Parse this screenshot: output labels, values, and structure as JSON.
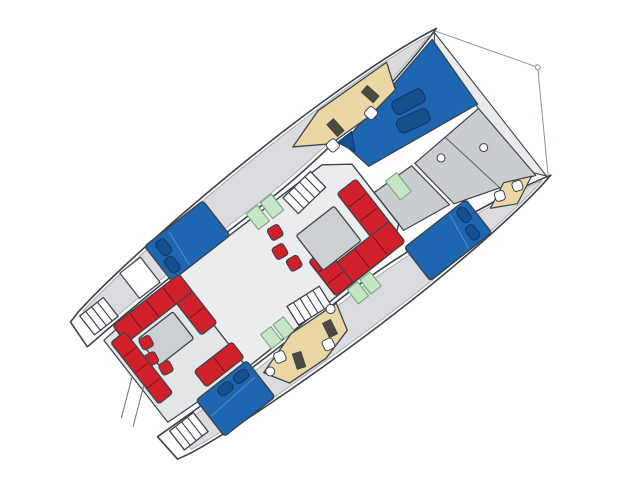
{
  "canvas": {
    "width": 640,
    "height": 478,
    "background": "#ffffff"
  },
  "boat": {
    "rotation_deg": 52,
    "origin_x": 492,
    "origin_y": 103,
    "description": "catamaran-deck-floorplan"
  },
  "palette": {
    "outline": "#3c424a",
    "soft_outline": "#8a9096",
    "hull_white": "#fdfdfd",
    "deck_gray": "#d9dbde",
    "panel_gray": "#c9ccd0",
    "saloon_gray": "#ebecee",
    "cockpit_gray": "#e4e5e7",
    "table_gray": "#cdd0d3",
    "berth_blue": "#1d67b2",
    "pillow_blue": "#164f8d",
    "seat_red": "#d2202a",
    "galley_tan": "#ead7a4",
    "equip_dark": "#4b4b43",
    "head_green": "#c5e5c6",
    "green_stroke": "#6fa173",
    "white": "#ffffff"
  },
  "legend": [
    {
      "color_key": "berth_blue",
      "meaning": "beds / sunpads / trampoline"
    },
    {
      "color_key": "seat_red",
      "meaning": "sofas and seating"
    },
    {
      "color_key": "galley_tan",
      "meaning": "galley / nav furniture"
    },
    {
      "color_key": "head_green",
      "meaning": "bathroom pads"
    },
    {
      "color_key": "panel_gray",
      "meaning": "deck panels / tables"
    }
  ],
  "shapes": [
    {
      "name": "bridle-line-port",
      "type": "line",
      "x1": -91,
      "y1": 0,
      "x2": 0,
      "y2": -58,
      "stroke": "#8a9096",
      "sw": 1
    },
    {
      "name": "bridle-line-starboard",
      "type": "line",
      "x1": 91,
      "y1": 0,
      "x2": 0,
      "y2": -58,
      "stroke": "#8a9096",
      "sw": 1
    },
    {
      "name": "bridle-ring",
      "type": "circle",
      "cx": 0,
      "cy": -58,
      "r": 2.5,
      "fill": "#ffffff",
      "stroke": "#8a9096",
      "sw": 1
    },
    {
      "name": "port-hull",
      "type": "path",
      "d": "M -93 -2 C -102 42 -107 130 -106 215 C -105 305 -99 402 -90 455 L -87 467 L -57 469 C -61 395 -62 315 -61 245 C -60 165 -77 55 -93 -2 Z",
      "fill": "#fdfdfd",
      "sw": 1.6
    },
    {
      "name": "starboard-hull",
      "type": "path",
      "d": "M 93 -2 C 102 42 107 130 106 215 C 105 305 99 402 90 455 L 87 467 L 57 469 C 61 395 62 315 61 245 C 60 165 77 55 93 -2 Z",
      "fill": "#fdfdfd",
      "sw": 1.6
    },
    {
      "name": "port-hull-deck",
      "type": "path",
      "d": "M -92 8 C -100 48 -104 132 -103 214 C -102 300 -96 398 -88 450 L -62 452 C -65 390 -66 312 -65 244 C -64 168 -79 60 -92 8 Z",
      "fill": "#d9dbde",
      "stroke": "#9aa0a6",
      "sw": 0.8
    },
    {
      "name": "starboard-hull-deck",
      "type": "path",
      "d": "M 92 8 C 100 48 104 132 103 214 C 102 300 96 398 88 450 L 62 452 C 65 390 66 312 65 244 C 64 168 79 60 92 8 Z",
      "fill": "#d9dbde",
      "stroke": "#9aa0a6",
      "sw": 0.8
    },
    {
      "name": "front-crossbeam",
      "type": "polygon",
      "points": "-91,2 91,2 76,14 -76,14",
      "fill": "#e9eaec",
      "sw": 1.1
    },
    {
      "name": "trampoline",
      "type": "polygon",
      "points": "-87,8 -8,12 -26,136 -60,142",
      "fill": "#1d67b2",
      "sw": 1.3
    },
    {
      "name": "trampoline-cushion-1",
      "type": "rect",
      "x": -60,
      "y": 48,
      "w": 15,
      "h": 34,
      "rx": 5,
      "rot": 10,
      "fill": "#164f8d",
      "stroke": "#0d3768",
      "sw": 1
    },
    {
      "name": "trampoline-cushion-2",
      "type": "rect",
      "x": -42,
      "y": 56,
      "w": 15,
      "h": 34,
      "rx": 5,
      "rot": 14,
      "fill": "#164f8d",
      "stroke": "#0d3768",
      "sw": 1
    },
    {
      "name": "trampoline-corner-cushion",
      "type": "polygon",
      "points": "-64,128 -46,138 -64,146",
      "fill": "#164f8d",
      "stroke": "#0d3768",
      "sw": 1
    },
    {
      "name": "foredeck-panel-1",
      "type": "polygon",
      "points": "-4,14 84,10 56,92 0,98",
      "fill": "#c9ccd0",
      "sw": 1.2
    },
    {
      "name": "foredeck-panel-2",
      "type": "polygon",
      "points": "0,102 54,96 46,148 -2,148",
      "fill": "#c9ccd0",
      "sw": 1.2
    },
    {
      "name": "foredeck-divider",
      "type": "line",
      "x1": -2,
      "y1": 58,
      "x2": 72,
      "y2": 46,
      "stroke": "#565b61",
      "sw": 1
    },
    {
      "name": "deck-hatch-1",
      "type": "circle",
      "cx": 30,
      "cy": 34,
      "r": 4,
      "fill": "#ffffff",
      "sw": 1
    },
    {
      "name": "deck-hatch-2",
      "type": "circle",
      "cx": 12,
      "cy": 74,
      "r": 4,
      "fill": "#ffffff",
      "sw": 1
    },
    {
      "name": "foredoor-green-pad",
      "type": "rect",
      "x": -4,
      "y": 118,
      "w": 24,
      "h": 14,
      "fill": "#c5e5c6",
      "stroke": "#6fa173",
      "sw": 1
    },
    {
      "name": "saloon-body",
      "type": "polygon",
      "points": "-56,172 -38,148 38,148 56,172 58,356 -58,356",
      "fill": "#ebecee",
      "sw": 1.4
    },
    {
      "name": "cockpit-floor",
      "type": "polygon",
      "points": "-58,356 58,356 52,452 -52,452",
      "fill": "#e4e5e7",
      "sw": 1.2
    },
    {
      "name": "port-nav-desk",
      "type": "path",
      "d": "M -97 58 L -70 68 L -65 104 L -67 152 L -88 184 L -101 142 Z",
      "fill": "#ead7a4",
      "sw": 1.3
    },
    {
      "name": "port-nav-equipment-1",
      "type": "rect",
      "x": -90,
      "y": 86,
      "w": 16,
      "h": 9,
      "rot": -10,
      "fill": "#4b4b43",
      "sw": 0.8
    },
    {
      "name": "port-nav-equipment-2",
      "type": "rect",
      "x": -85,
      "y": 134,
      "w": 16,
      "h": 9,
      "rot": -4,
      "fill": "#4b4b43",
      "sw": 0.8
    },
    {
      "name": "port-nav-chair-1",
      "type": "rect",
      "x": -72,
      "y": 96,
      "w": 11,
      "h": 11,
      "rx": 3,
      "rot": -10,
      "fill": "#ffffff",
      "sw": 1
    },
    {
      "name": "port-nav-chair-2",
      "type": "rect",
      "x": -70,
      "y": 146,
      "w": 11,
      "h": 11,
      "rx": 3,
      "rot": -4,
      "fill": "#ffffff",
      "sw": 1
    },
    {
      "name": "port-companionway-stairs",
      "type": "stairs",
      "x": -56,
      "y": 184,
      "w": 22,
      "h": 38,
      "steps": 5,
      "rot": -6
    },
    {
      "name": "port-head-green-pad-1",
      "type": "rect",
      "x": -64,
      "y": 230,
      "w": 20,
      "h": 14,
      "fill": "#c5e5c6",
      "stroke": "#6fa173",
      "sw": 1
    },
    {
      "name": "port-head-green-pad-2",
      "type": "rect",
      "x": -64,
      "y": 248,
      "w": 20,
      "h": 14,
      "fill": "#c5e5c6",
      "stroke": "#6fa173",
      "sw": 1
    },
    {
      "name": "port-aft-cabin-bed",
      "type": "rect",
      "x": -101,
      "y": 288,
      "w": 44,
      "h": 74,
      "rx": 3,
      "fill": "#1d67b2",
      "sw": 1.4
    },
    {
      "name": "port-bed-crease",
      "type": "line",
      "x1": -97,
      "y1": 334,
      "x2": -59,
      "y2": 338,
      "stroke": "#4e86c6",
      "sw": 1.2
    },
    {
      "name": "port-bed-pillow-1",
      "type": "rect",
      "x": -97,
      "y": 342,
      "w": 17,
      "h": 11,
      "rx": 4,
      "fill": "#164f8d",
      "stroke": "#0d3768",
      "sw": 1
    },
    {
      "name": "port-bed-pillow-2",
      "type": "rect",
      "x": -78,
      "y": 346,
      "w": 17,
      "h": 11,
      "rx": 4,
      "fill": "#164f8d",
      "stroke": "#0d3768",
      "sw": 1
    },
    {
      "name": "port-aft-berth-white",
      "type": "rect",
      "x": -95,
      "y": 372,
      "w": 32,
      "h": 26,
      "fill": "#ffffff",
      "sw": 1.2
    },
    {
      "name": "port-transom-steps",
      "type": "stairs",
      "x": -86,
      "y": 426,
      "w": 24,
      "h": 30,
      "steps": 4,
      "rot": 0
    },
    {
      "name": "saloon-sofa-front-bench",
      "type": "rect",
      "x": -24,
      "y": 154,
      "w": 72,
      "h": 24,
      "rx": 3,
      "seg": 4,
      "fill": "#d2202a",
      "sw": 1.3
    },
    {
      "name": "saloon-sofa-right-bench",
      "type": "rect",
      "x": 30,
      "y": 154,
      "w": 26,
      "h": 88,
      "rx": 3,
      "seg": 4,
      "fill": "#d2202a",
      "sw": 1.3
    },
    {
      "name": "saloon-sofa-return-bench",
      "type": "rect",
      "x": 12,
      "y": 220,
      "w": 44,
      "h": 22,
      "rx": 3,
      "seg": 3,
      "fill": "#d2202a",
      "sw": 1.3
    },
    {
      "name": "saloon-table",
      "type": "rect",
      "x": -16,
      "y": 188,
      "w": 44,
      "h": 48,
      "rx": 2,
      "fill": "#cdd0d3",
      "sw": 1.3
    },
    {
      "name": "saloon-stool-1",
      "type": "rect",
      "x": -38,
      "y": 244,
      "w": 13,
      "h": 13,
      "rx": 3,
      "rot": 8,
      "fill": "#d2202a",
      "sw": 1.1
    },
    {
      "name": "saloon-stool-2",
      "type": "rect",
      "x": -20,
      "y": 252,
      "w": 13,
      "h": 13,
      "rx": 3,
      "rot": 8,
      "fill": "#d2202a",
      "sw": 1.1
    },
    {
      "name": "saloon-stool-3",
      "type": "rect",
      "x": -2,
      "y": 248,
      "w": 13,
      "h": 13,
      "rx": 3,
      "rot": 8,
      "fill": "#d2202a",
      "sw": 1.1
    },
    {
      "name": "starboard-companionway-stairs",
      "type": "stairs",
      "x": 36,
      "y": 250,
      "w": 22,
      "h": 38,
      "steps": 5,
      "rot": 6
    },
    {
      "name": "starboard-saloon-green-1",
      "type": "rect",
      "x": 40,
      "y": 296,
      "w": 18,
      "h": 13,
      "fill": "#c5e5c6",
      "stroke": "#6fa173",
      "sw": 1
    },
    {
      "name": "starboard-saloon-green-2",
      "type": "rect",
      "x": 40,
      "y": 312,
      "w": 18,
      "h": 13,
      "fill": "#c5e5c6",
      "stroke": "#6fa173",
      "sw": 1
    },
    {
      "name": "starboard-bow-seats",
      "type": "polygon",
      "points": "82,14 95,42 82,66 70,40",
      "fill": "#ead7a4",
      "sw": 1.2
    },
    {
      "name": "starboard-bow-chair-1",
      "type": "rect",
      "x": 76,
      "y": 26,
      "w": 10,
      "h": 10,
      "rx": 3,
      "rot": 20,
      "fill": "#ffffff",
      "sw": 1
    },
    {
      "name": "starboard-bow-chair-2",
      "type": "rect",
      "x": 73,
      "y": 46,
      "w": 10,
      "h": 10,
      "rx": 3,
      "rot": 20,
      "fill": "#ffffff",
      "sw": 1
    },
    {
      "name": "starboard-fwd-cabin-bed",
      "type": "rect",
      "x": 60,
      "y": 80,
      "w": 42,
      "h": 78,
      "rx": 3,
      "fill": "#1d67b2",
      "sw": 1.4
    },
    {
      "name": "starboard-fwd-pillow-1",
      "type": "rect",
      "x": 63,
      "y": 86,
      "w": 16,
      "h": 10,
      "rx": 4,
      "fill": "#164f8d",
      "stroke": "#0d3768",
      "sw": 1
    },
    {
      "name": "starboard-fwd-pillow-2",
      "type": "rect",
      "x": 82,
      "y": 90,
      "w": 16,
      "h": 10,
      "rx": 4,
      "fill": "#164f8d",
      "stroke": "#0d3768",
      "sw": 1
    },
    {
      "name": "starboard-fwd-bed-crease",
      "type": "line",
      "x1": 62,
      "y1": 102,
      "x2": 100,
      "y2": 108,
      "stroke": "#4e86c6",
      "sw": 1.2
    },
    {
      "name": "starboard-head-green-1",
      "type": "rect",
      "x": 58,
      "y": 200,
      "w": 18,
      "h": 13,
      "fill": "#c5e5c6",
      "stroke": "#6fa173",
      "sw": 1
    },
    {
      "name": "starboard-head-green-2",
      "type": "rect",
      "x": 58,
      "y": 216,
      "w": 18,
      "h": 13,
      "fill": "#c5e5c6",
      "stroke": "#6fa173",
      "sw": 1
    },
    {
      "name": "starboard-galley-counter",
      "type": "path",
      "d": "M 62 246 L 90 254 L 99 288 L 96 332 L 72 346 L 58 300 Z",
      "fill": "#ead7a4",
      "sw": 1.3
    },
    {
      "name": "starboard-galley-stove-1",
      "type": "rect",
      "x": 70,
      "y": 262,
      "w": 16,
      "h": 9,
      "rot": 12,
      "fill": "#4b4b43",
      "sw": 0.8
    },
    {
      "name": "starboard-galley-stove-2",
      "type": "rect",
      "x": 76,
      "y": 306,
      "w": 16,
      "h": 9,
      "rot": 20,
      "fill": "#4b4b43",
      "sw": 0.8
    },
    {
      "name": "starboard-galley-chair-1",
      "type": "rect",
      "x": 84,
      "y": 272,
      "w": 11,
      "h": 11,
      "rx": 3,
      "rot": 12,
      "fill": "#ffffff",
      "sw": 1
    },
    {
      "name": "starboard-galley-chair-2",
      "type": "rect",
      "x": 64,
      "y": 318,
      "w": 11,
      "h": 11,
      "rx": 3,
      "rot": 16,
      "fill": "#ffffff",
      "sw": 1
    },
    {
      "name": "starboard-galley-stool-1",
      "type": "circle",
      "cx": 63,
      "cy": 254,
      "r": 4.5,
      "fill": "#ffffff",
      "sw": 1
    },
    {
      "name": "starboard-galley-stool-2",
      "type": "circle",
      "cx": 75,
      "cy": 340,
      "r": 4.5,
      "fill": "#ffffff",
      "sw": 1
    },
    {
      "name": "cockpit-sofa-fwd-bench",
      "type": "rect",
      "x": -58,
      "y": 352,
      "w": 62,
      "h": 20,
      "rx": 3,
      "seg": 3,
      "fill": "#d2202a",
      "sw": 1.3
    },
    {
      "name": "cockpit-sofa-port-bench",
      "type": "rect",
      "x": -58,
      "y": 352,
      "w": 22,
      "h": 84,
      "rx": 3,
      "seg": 4,
      "fill": "#d2202a",
      "sw": 1.3
    },
    {
      "name": "cockpit-table",
      "type": "rect",
      "x": -32,
      "y": 380,
      "w": 34,
      "h": 44,
      "rx": 2,
      "fill": "#cdd0d3",
      "sw": 1.3
    },
    {
      "name": "cockpit-stool-1",
      "type": "rect",
      "x": -30,
      "y": 414,
      "w": 12,
      "h": 12,
      "rx": 3,
      "rot": 10,
      "fill": "#d2202a",
      "sw": 1.1
    },
    {
      "name": "cockpit-stool-2",
      "type": "rect",
      "x": -14,
      "y": 420,
      "w": 12,
      "h": 12,
      "rx": 3,
      "rot": 10,
      "fill": "#d2202a",
      "sw": 1.1
    },
    {
      "name": "cockpit-stool-3",
      "type": "rect",
      "x": 2,
      "y": 414,
      "w": 12,
      "h": 12,
      "rx": 3,
      "rot": 10,
      "fill": "#d2202a",
      "sw": 1.1
    },
    {
      "name": "cockpit-stb-seat",
      "type": "rect",
      "x": 28,
      "y": 352,
      "w": 20,
      "h": 48,
      "rx": 3,
      "seg": 2,
      "fill": "#d2202a",
      "sw": 1.3
    },
    {
      "name": "cockpit-aft-bench",
      "type": "rect",
      "x": -46,
      "y": 430,
      "w": 78,
      "h": 18,
      "rx": 3,
      "seg": 4,
      "fill": "#d2202a",
      "sw": 1.3
    },
    {
      "name": "starboard-aft-cabin-bed",
      "type": "rect",
      "x": 52,
      "y": 352,
      "w": 46,
      "h": 64,
      "rx": 3,
      "fill": "#1d67b2",
      "sw": 1.4
    },
    {
      "name": "starboard-aft-pillow-1",
      "type": "rect",
      "x": 56,
      "y": 358,
      "w": 10,
      "h": 16,
      "rx": 4,
      "fill": "#164f8d",
      "stroke": "#0d3768",
      "sw": 1
    },
    {
      "name": "starboard-aft-pillow-2",
      "type": "rect",
      "x": 56,
      "y": 378,
      "w": 10,
      "h": 16,
      "rx": 4,
      "fill": "#164f8d",
      "stroke": "#0d3768",
      "sw": 1
    },
    {
      "name": "starboard-aft-bed-crease",
      "type": "line",
      "x1": 70,
      "y1": 356,
      "x2": 74,
      "y2": 414,
      "stroke": "#4e86c6",
      "sw": 1.2
    },
    {
      "name": "starboard-transom-steps",
      "type": "stairs",
      "x": 60,
      "y": 426,
      "w": 24,
      "h": 30,
      "steps": 4,
      "rot": 0
    },
    {
      "name": "davit-line-1",
      "type": "line",
      "x1": -6,
      "y1": 452,
      "x2": 20,
      "y2": 486,
      "stroke": "#6a7076",
      "sw": 1
    },
    {
      "name": "davit-line-2",
      "type": "line",
      "x1": 8,
      "y1": 448,
      "x2": 34,
      "y2": 482,
      "stroke": "#6a7076",
      "sw": 1
    }
  ]
}
